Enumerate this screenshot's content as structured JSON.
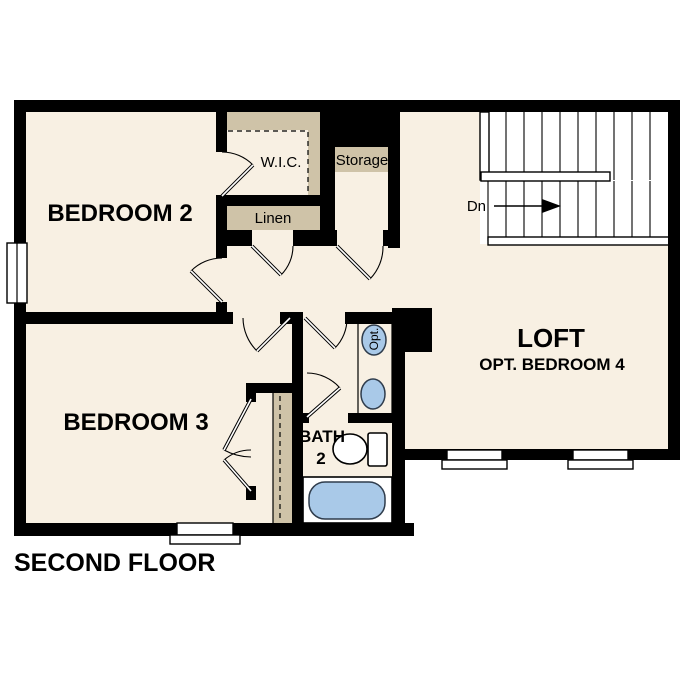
{
  "title": "SECOND FLOOR",
  "rooms": {
    "bedroom2": {
      "label": "BEDROOM 2"
    },
    "bedroom3": {
      "label": "BEDROOM 3"
    },
    "loft": {
      "label": "LOFT",
      "sublabel": "OPT. BEDROOM 4"
    },
    "bath": {
      "label_line1": "BATH",
      "label_line2": "2"
    },
    "wic": {
      "label": "W.I.C."
    },
    "linen": {
      "label": "Linen"
    },
    "storage": {
      "label": "Storage"
    }
  },
  "stairs": {
    "direction_label": "Dn"
  },
  "fixtures": {
    "optional_sink_label": "Opt."
  },
  "colors": {
    "wall": "#000000",
    "floor": "#f8f0e3",
    "casework_tan": "#cfc3a8",
    "fixture_blue": "#a9c9e8",
    "stairwell": "#ffffff",
    "background": "#ffffff"
  }
}
